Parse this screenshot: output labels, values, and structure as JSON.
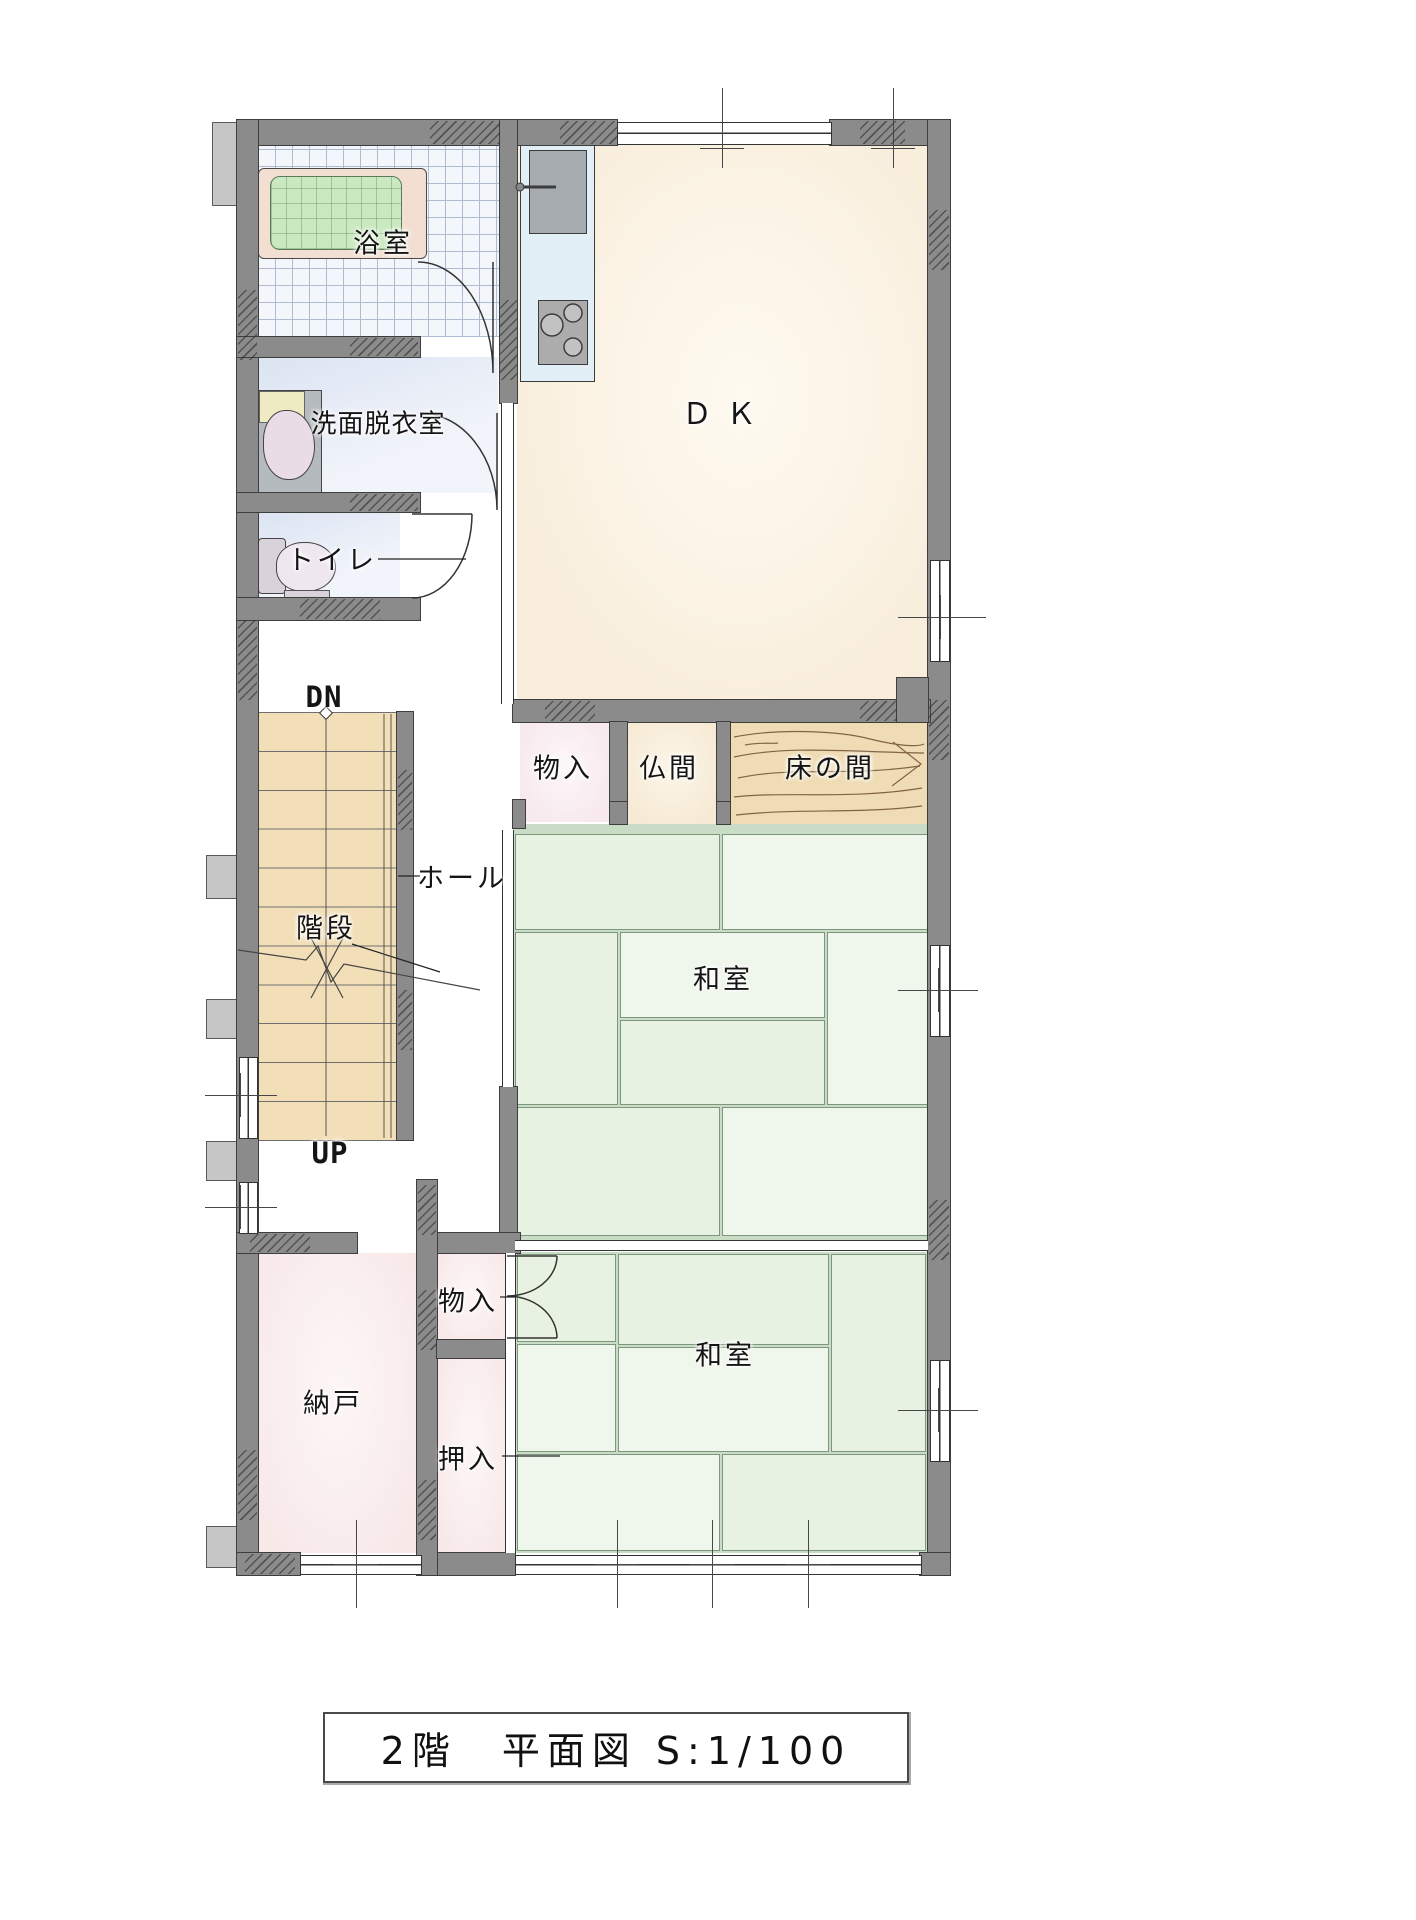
{
  "title": {
    "text": "2階　平面図 S:1/100"
  },
  "rooms": {
    "bath": "浴室",
    "washroom": "洗面脱衣室",
    "toilet": "トイレ",
    "dining_kitchen": "ＤＫ",
    "storage_mid": "物入",
    "butsuma": "仏間",
    "tokonoma": "床の間",
    "hall": "ホール",
    "stairs": "階段",
    "washitsu_upper": "和室",
    "washitsu_lower": "和室",
    "nando": "納戸",
    "storage_small": "物入",
    "oshiire": "押入"
  },
  "stair_labels": {
    "down": "DN",
    "up": "UP"
  },
  "colors": {
    "wall": "#8B8B8B",
    "wall-edge": "#3E3E3E",
    "bump": "#C6C6C6",
    "line": "#333333",
    "tile-floor": "#F3F6FB",
    "tile-line": "#AEBBD2",
    "tub-rim": "#F2DFD2",
    "tub": "#CBE9C1",
    "dk-floor": "#F9EEDC",
    "counter": "#E2EFF6",
    "appliance": "#A6ABAF",
    "storage-floor": "#F7E9ED",
    "butsuma-floor": "#F6EAD5",
    "wood": "#EFDCB4",
    "wood-line": "#6E4F33",
    "tatami": "#E8F2E3",
    "tatami-alt": "#EFF6EB",
    "tatami-gap": "#C9DCC6",
    "tatami-line": "#7D967D",
    "stair-floor": "#F2DFB8",
    "closet-floor": "#F8E9E9",
    "fixture": "#B9BDC0"
  }
}
